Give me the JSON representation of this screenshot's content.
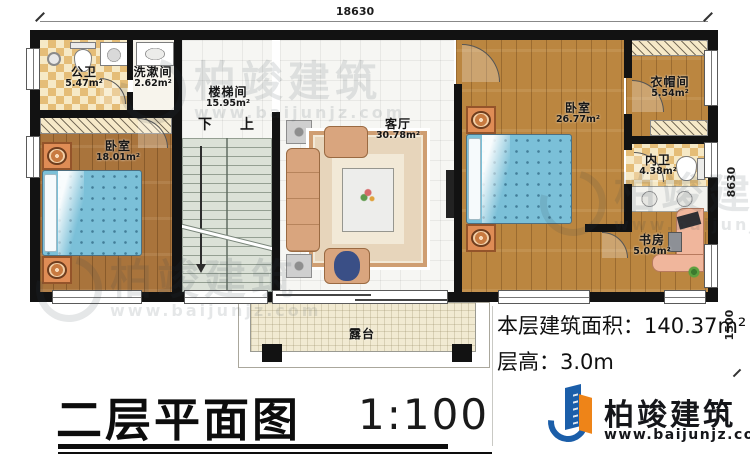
{
  "plan": {
    "title": "二层平面图",
    "scale": "1:100",
    "info": {
      "area_label": "本层建筑面积：",
      "area_value": "140.37m²",
      "height_label": "层高：",
      "height_value": "3.0m"
    },
    "dimensions": {
      "top": "18630",
      "right": "8630",
      "right_lower": "1500"
    }
  },
  "rooms": [
    {
      "id": "public-bath",
      "name": "公卫",
      "area": "5.47m²"
    },
    {
      "id": "washroom",
      "name": "洗漱间",
      "area": "2.62m²"
    },
    {
      "id": "stairwell",
      "name": "楼梯间",
      "area": "15.95m²"
    },
    {
      "id": "bedroom-left",
      "name": "卧室",
      "area": "18.01m²"
    },
    {
      "id": "living-room",
      "name": "客厅",
      "area": "30.78m²"
    },
    {
      "id": "bedroom-master",
      "name": "卧室",
      "area": "26.77m²"
    },
    {
      "id": "cloakroom",
      "name": "衣帽间",
      "area": "5.54m²"
    },
    {
      "id": "ensuite-bath",
      "name": "内卫",
      "area": "4.38m²"
    },
    {
      "id": "study",
      "name": "书房",
      "area": "5.04m²"
    },
    {
      "id": "terrace",
      "name": "露台",
      "area": ""
    }
  ],
  "stairs": {
    "down": "下",
    "up": "上"
  },
  "brand": {
    "name": "柏竣建筑",
    "url": "www.baijunjz.com"
  },
  "watermark": {
    "name": "柏竣建筑",
    "url": "www.baijunjz.com"
  },
  "colors": {
    "wall": "#121212",
    "wood": "#bb8640",
    "wood_dark": "#a9743c",
    "tile_checker": "#e5bd77",
    "bed_blue": "#7bc0d8",
    "accent_blue": "#1b5ea9",
    "accent_orange": "#ee8418"
  }
}
